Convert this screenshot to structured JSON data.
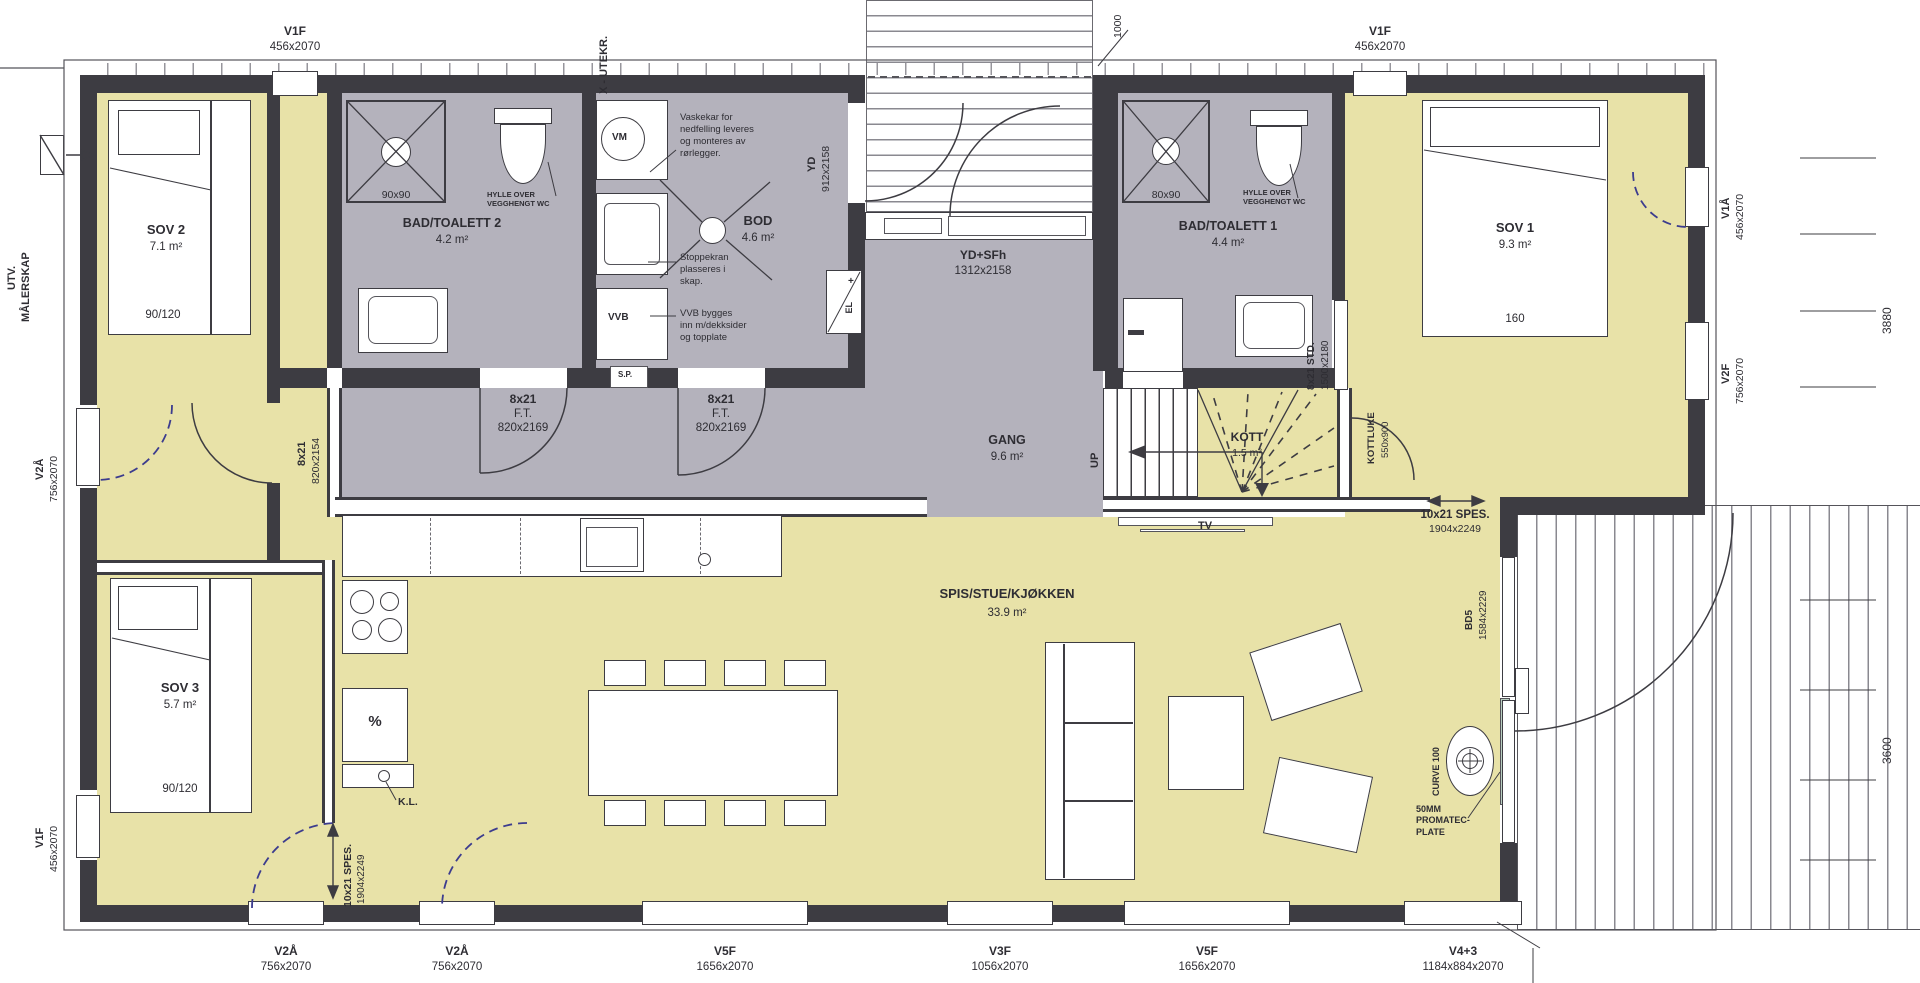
{
  "colors": {
    "room_yellow": "#e8e2a8",
    "room_gray": "#b4b2bc",
    "wall": "#3d3c42",
    "door_blue": "#3c3c8e",
    "promatec_green": "#b9cfc1"
  },
  "top": {
    "v1f_left": {
      "code": "V1F",
      "size": "456x2070"
    },
    "x_utekr": "X - UTEKR.",
    "dim_1000": "1000",
    "v1f_right": {
      "code": "V1F",
      "size": "456x2070"
    }
  },
  "left": {
    "utv_line1": "UTV.",
    "utv_line2": "MÅLERSKAP",
    "v2a": {
      "code": "V2Å",
      "size": "756x2070"
    },
    "v1f": {
      "code": "V1F",
      "size": "456x2070"
    }
  },
  "right": {
    "v1a": {
      "code": "V1Å",
      "size": "456x2070"
    },
    "v2f": {
      "code": "V2F",
      "size": "756x2070"
    },
    "dim_3880": "3880",
    "dim_3600": "3600"
  },
  "bottom": [
    {
      "code": "V2Å",
      "size": "756x2070"
    },
    {
      "code": "V2Å",
      "size": "756x2070"
    },
    {
      "code": "V5F",
      "size": "1656x2070"
    },
    {
      "code": "V3F",
      "size": "1056x2070"
    },
    {
      "code": "V5F",
      "size": "1656x2070"
    },
    {
      "code": "V4+3",
      "size": "1184x884x2070"
    }
  ],
  "rooms": {
    "sov1": {
      "name": "SOV 1",
      "area": "9.3 m²",
      "bed": "160"
    },
    "sov2": {
      "name": "SOV 2",
      "area": "7.1 m²",
      "bed": "90/120"
    },
    "sov3": {
      "name": "SOV 3",
      "area": "5.7 m²",
      "bed": "90/120"
    },
    "bad1": {
      "name": "BAD/TOALETT 1",
      "area": "4.4 m²",
      "shower": "80x90",
      "shelf": "HYLLE OVER\nVEGGHENGT WC"
    },
    "bad2": {
      "name": "BAD/TOALETT 2",
      "area": "4.2 m²",
      "shower": "90x90",
      "shelf": "HYLLE OVER\nVEGGHENGT WC"
    },
    "bod": {
      "name": "BOD",
      "area": "4.6 m²"
    },
    "gang": {
      "name": "GANG",
      "area": "9.6 m²"
    },
    "kott": {
      "name": "KOTT",
      "area": "1.5 m²"
    },
    "stue": {
      "name": "SPIS/STUE/KJØKKEN",
      "area": "33.9 m²"
    }
  },
  "doors": {
    "yd": {
      "code": "YD",
      "size": "912x2158"
    },
    "ydsfh": {
      "code": "YD+SFh",
      "size": "1312x2158"
    },
    "sov2_door": {
      "code": "8x21",
      "size": "820x2154"
    },
    "ft1": {
      "code": "8x21",
      "type": "F.T.",
      "size": "820x2169"
    },
    "ft2": {
      "code": "8x21",
      "type": "F.T.",
      "size": "820x2169"
    },
    "std": {
      "code": "8x21 STD.",
      "size": "1500x2180"
    },
    "kottluke": {
      "code": "KOTTLUKE",
      "size": "550x900"
    },
    "spes_right": {
      "code": "10x21 SPES.",
      "size": "1904x2249"
    },
    "spes_bottom": {
      "code": "10x21 SPES.",
      "size": "1904x2249"
    },
    "bd5": {
      "code": "BD5",
      "size": "1584x2229"
    }
  },
  "annotations": {
    "vm": "VM",
    "vvb": "VVB",
    "sp": "S.P.",
    "el": "EL",
    "el_plus": "+",
    "up": "UP",
    "tv": "TV",
    "kl": "K.L.",
    "percent": "%",
    "curve": "CURVE 100",
    "promatec": "50MM\nPROMATEC-\nPLATE",
    "vaskekar": "Vaskekar for\nnedfelling leveres\nog monteres av\nrørlegger.",
    "stoppekran": "Stoppekran\nplasseres i\nskap.",
    "vvb_note": "VVB bygges\ninn m/dekksider\nog topplate"
  }
}
